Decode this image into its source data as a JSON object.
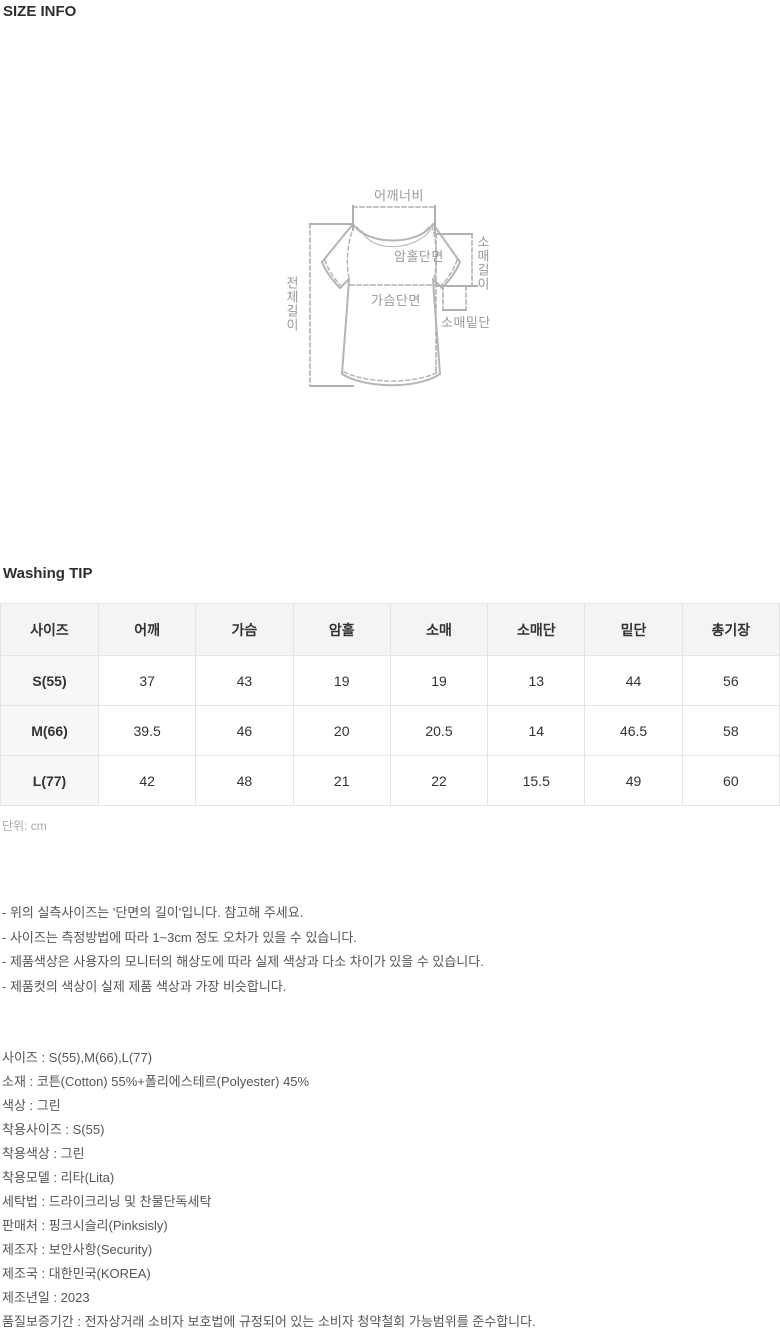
{
  "titles": {
    "size_info": "SIZE INFO",
    "washing_tip": "Washing TIP"
  },
  "colors": {
    "table_header_bg": "#f4f4f4",
    "table_row_header_bg": "#f7f7f7",
    "table_border": "#e4e4e4",
    "diagram_line": "#b5b5b5",
    "diagram_label": "#999999",
    "body_text": "#555555",
    "title_text": "#2e2e2e"
  },
  "diagram": {
    "labels": {
      "shoulder_width": "어깨너비",
      "total_length": "전체길이",
      "armhole": "암홀단면",
      "chest": "가슴단면",
      "sleeve_length": "소매길이",
      "sleeve_hem": "소매밑단"
    }
  },
  "size_table": {
    "headers": [
      "사이즈",
      "어깨",
      "가슴",
      "암홀",
      "소매",
      "소매단",
      "밑단",
      "총기장"
    ],
    "rows": [
      {
        "size": "S(55)",
        "values": [
          "37",
          "43",
          "19",
          "19",
          "13",
          "44",
          "56"
        ]
      },
      {
        "size": "M(66)",
        "values": [
          "39.5",
          "46",
          "20",
          "20.5",
          "14",
          "46.5",
          "58"
        ]
      },
      {
        "size": "L(77)",
        "values": [
          "42",
          "48",
          "21",
          "22",
          "15.5",
          "49",
          "60"
        ]
      }
    ],
    "unit": "단위: cm"
  },
  "notes": [
    "- 위의 실측사이즈는 '단면의 길이'입니다. 참고해 주세요.",
    "- 사이즈는 측정방법에 따라 1~3cm 정도 오차가 있을 수 있습니다.",
    "- 제품색상은 사용자의 모니터의 해상도에 따라 실제 색상과 다소 차이가 있을 수 있습니다.",
    "- 제품컷의 색상이 실제 제품 색상과 가장 비슷합니다."
  ],
  "details": [
    "사이즈 : S(55),M(66),L(77)",
    "소재 : 코튼(Cotton) 55%+폴리에스테르(Polyester) 45%",
    "색상 : 그린",
    "착용사이즈 : S(55)",
    "착용색상 : 그린",
    "착용모델 : 리타(Lita)",
    "세탁법 : 드라이크리닝 및 찬물단독세탁",
    "판매처 : 핑크시슬리(Pinksisly)",
    "제조자 : 보안사항(Security)",
    "제조국 : 대한민국(KOREA)",
    "제조년일 : 2023",
    "품질보증기간 : 전자상거래 소비자 보호법에 규정되어 있는 소비자 청약철회 가능범위를 준수합니다."
  ]
}
